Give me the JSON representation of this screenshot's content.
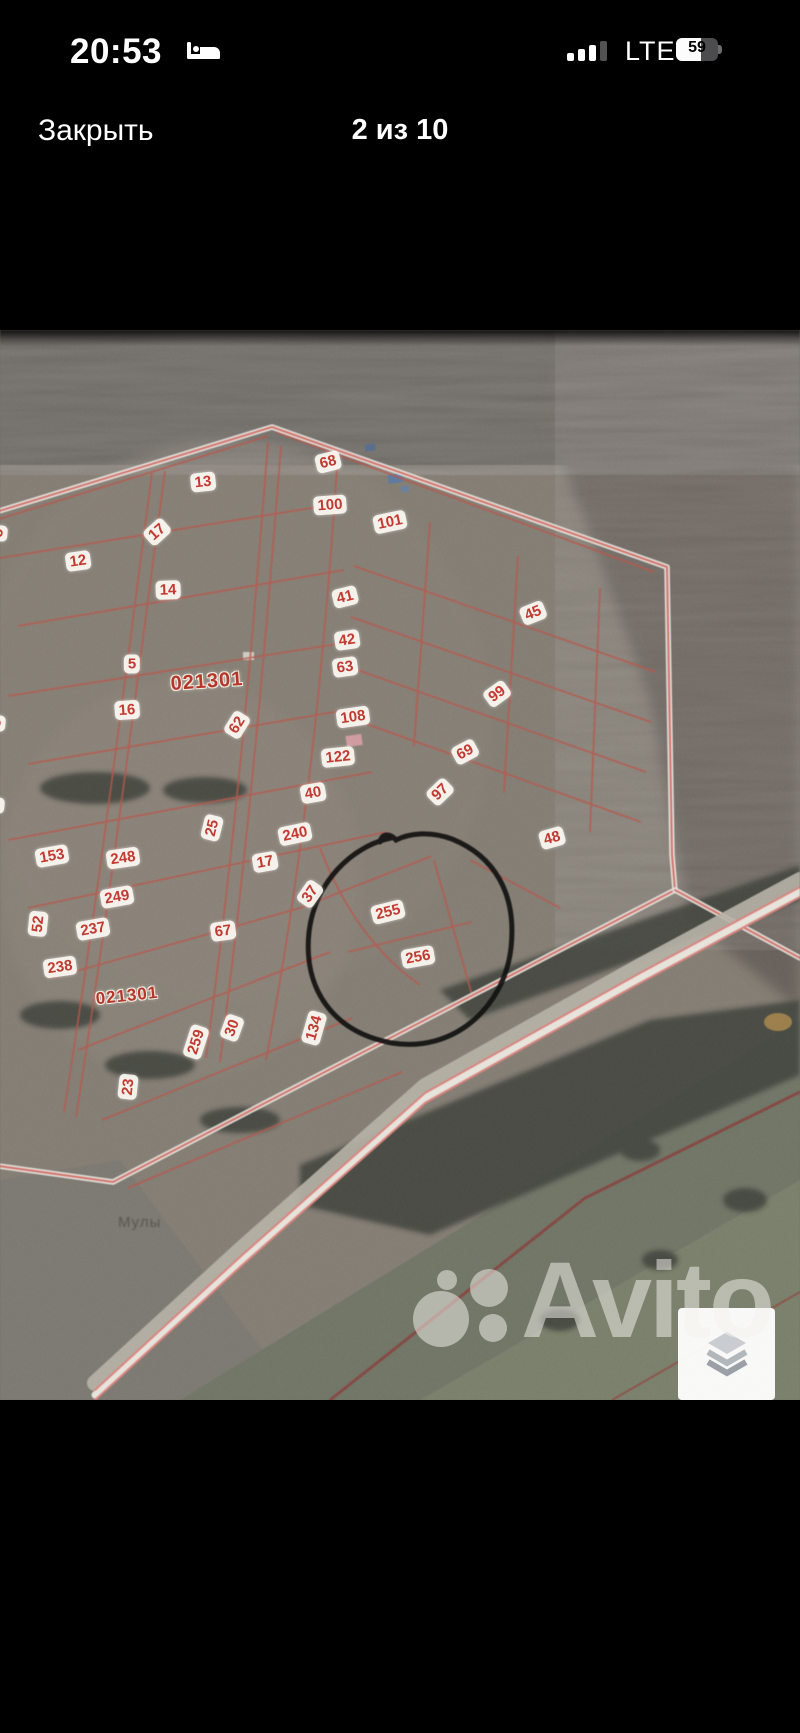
{
  "status_bar": {
    "time": "20:53",
    "sleep_icon": "bed-icon",
    "signal_icon": "cellular-signal-icon",
    "network": "LTE",
    "battery_percent": "59"
  },
  "header": {
    "close_label": "Закрыть",
    "counter": "2 из 10"
  },
  "photo": {
    "watermark_text": "Avito",
    "place_label": "Мулы",
    "quarter_labels": [
      {
        "text": "021301",
        "x": 207,
        "y": 682,
        "size": 20,
        "r": -4
      },
      {
        "text": "021301",
        "x": 127,
        "y": 996,
        "size": 17,
        "r": -6
      }
    ],
    "plot_labels": [
      {
        "t": "68",
        "x": 328,
        "y": 462,
        "r": -14
      },
      {
        "t": "13",
        "x": 203,
        "y": 482,
        "r": -6
      },
      {
        "t": "100",
        "x": 330,
        "y": 505,
        "r": -4
      },
      {
        "t": "101",
        "x": 390,
        "y": 522,
        "r": -12
      },
      {
        "t": "17",
        "x": 157,
        "y": 532,
        "r": -42
      },
      {
        "t": "12",
        "x": 78,
        "y": 561,
        "r": -8
      },
      {
        "t": "14",
        "x": 168,
        "y": 590,
        "r": -2
      },
      {
        "t": "41",
        "x": 345,
        "y": 597,
        "r": -14
      },
      {
        "t": "45",
        "x": 533,
        "y": 613,
        "r": -22
      },
      {
        "t": "42",
        "x": 347,
        "y": 640,
        "r": -8
      },
      {
        "t": "5",
        "x": 132,
        "y": 664,
        "r": 0
      },
      {
        "t": "63",
        "x": 345,
        "y": 667,
        "r": -8
      },
      {
        "t": "16",
        "x": 127,
        "y": 710,
        "r": -4
      },
      {
        "t": "108",
        "x": 353,
        "y": 717,
        "r": -8
      },
      {
        "t": "99",
        "x": 497,
        "y": 694,
        "r": -36
      },
      {
        "t": "62",
        "x": 237,
        "y": 725,
        "r": -58
      },
      {
        "t": "69",
        "x": 465,
        "y": 752,
        "r": -28
      },
      {
        "t": "122",
        "x": 338,
        "y": 757,
        "r": -6
      },
      {
        "t": "40",
        "x": 313,
        "y": 793,
        "r": -10
      },
      {
        "t": "97",
        "x": 440,
        "y": 792,
        "r": -44
      },
      {
        "t": "25",
        "x": 212,
        "y": 828,
        "r": -76
      },
      {
        "t": "240",
        "x": 295,
        "y": 834,
        "r": -12
      },
      {
        "t": "48",
        "x": 552,
        "y": 838,
        "r": -16
      },
      {
        "t": "153",
        "x": 52,
        "y": 856,
        "r": -10
      },
      {
        "t": "248",
        "x": 123,
        "y": 858,
        "r": -8
      },
      {
        "t": "17",
        "x": 265,
        "y": 862,
        "r": -10
      },
      {
        "t": "249",
        "x": 117,
        "y": 897,
        "r": -10
      },
      {
        "t": "37",
        "x": 310,
        "y": 894,
        "r": -55
      },
      {
        "t": "52",
        "x": 38,
        "y": 924,
        "r": -84
      },
      {
        "t": "237",
        "x": 93,
        "y": 929,
        "r": -10
      },
      {
        "t": "255",
        "x": 388,
        "y": 912,
        "r": -14
      },
      {
        "t": "67",
        "x": 223,
        "y": 931,
        "r": -8
      },
      {
        "t": "256",
        "x": 418,
        "y": 957,
        "r": -10
      },
      {
        "t": "238",
        "x": 60,
        "y": 967,
        "r": -8
      },
      {
        "t": "259",
        "x": 196,
        "y": 1042,
        "r": -72
      },
      {
        "t": "30",
        "x": 232,
        "y": 1028,
        "r": -70
      },
      {
        "t": "134",
        "x": 314,
        "y": 1028,
        "r": -74
      },
      {
        "t": "23",
        "x": 128,
        "y": 1087,
        "r": -84
      },
      {
        "t": "5",
        "x": -2,
        "y": 533,
        "r": -85
      },
      {
        "t": "3",
        "x": -4,
        "y": 723,
        "r": -85
      },
      {
        "t": "2",
        "x": -5,
        "y": 805,
        "r": -85
      }
    ],
    "annotation": {
      "shape": "hand-drawn-circle",
      "around_plots": "255, 256",
      "color": "#111111"
    },
    "layers_icon": "layers-icon",
    "colors": {
      "label_red": "#c23a31",
      "boundary_red": "#e0564c",
      "road_pink": "#ea746b",
      "watermark_white": "rgba(244,242,236,0.52)"
    }
  }
}
